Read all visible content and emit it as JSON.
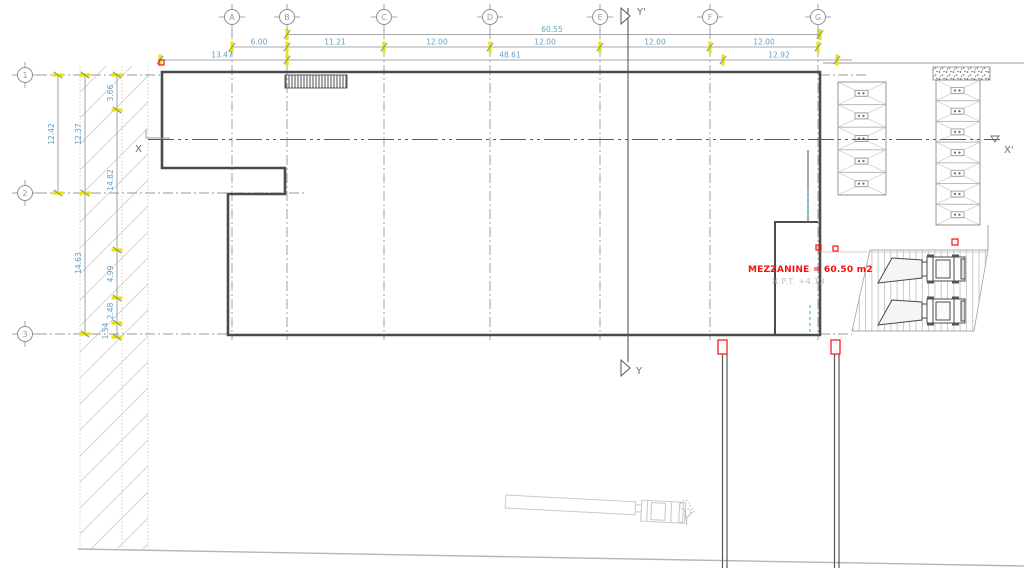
{
  "title": "warehouse-ground-floor-plan",
  "grid": {
    "columns": [
      "A",
      "B",
      "C",
      "D",
      "E",
      "F",
      "G"
    ],
    "rows": [
      "1",
      "2",
      "3"
    ]
  },
  "axes": {
    "x": "X",
    "x_prime": "X'",
    "y": "Y",
    "y_prime": "Y'"
  },
  "dims": {
    "total": "60.55",
    "bays": [
      "6.00",
      "11.21",
      "12.00",
      "12.00",
      "12.00",
      "12.00"
    ],
    "overall": [
      "13.47",
      "48.61",
      "12.92"
    ],
    "left_a": "12.42",
    "left_b": [
      "12.37",
      "14.63"
    ],
    "left_c": [
      "3.66",
      "14.82",
      "4.99",
      "2.48",
      "1.54"
    ]
  },
  "annotations": {
    "mezzanine": "MEZZANINE = 60.50 m2",
    "npt": "N.P.T. +4.13"
  },
  "colors": {
    "dimension_text": "#64a0c8",
    "tick_highlight": "#e8e500",
    "wall": "#4b4b4b",
    "alert_red": "#fa0f0c",
    "hidden_cyan": "#3fc0d6",
    "muted_text": "#bcbcbc"
  }
}
